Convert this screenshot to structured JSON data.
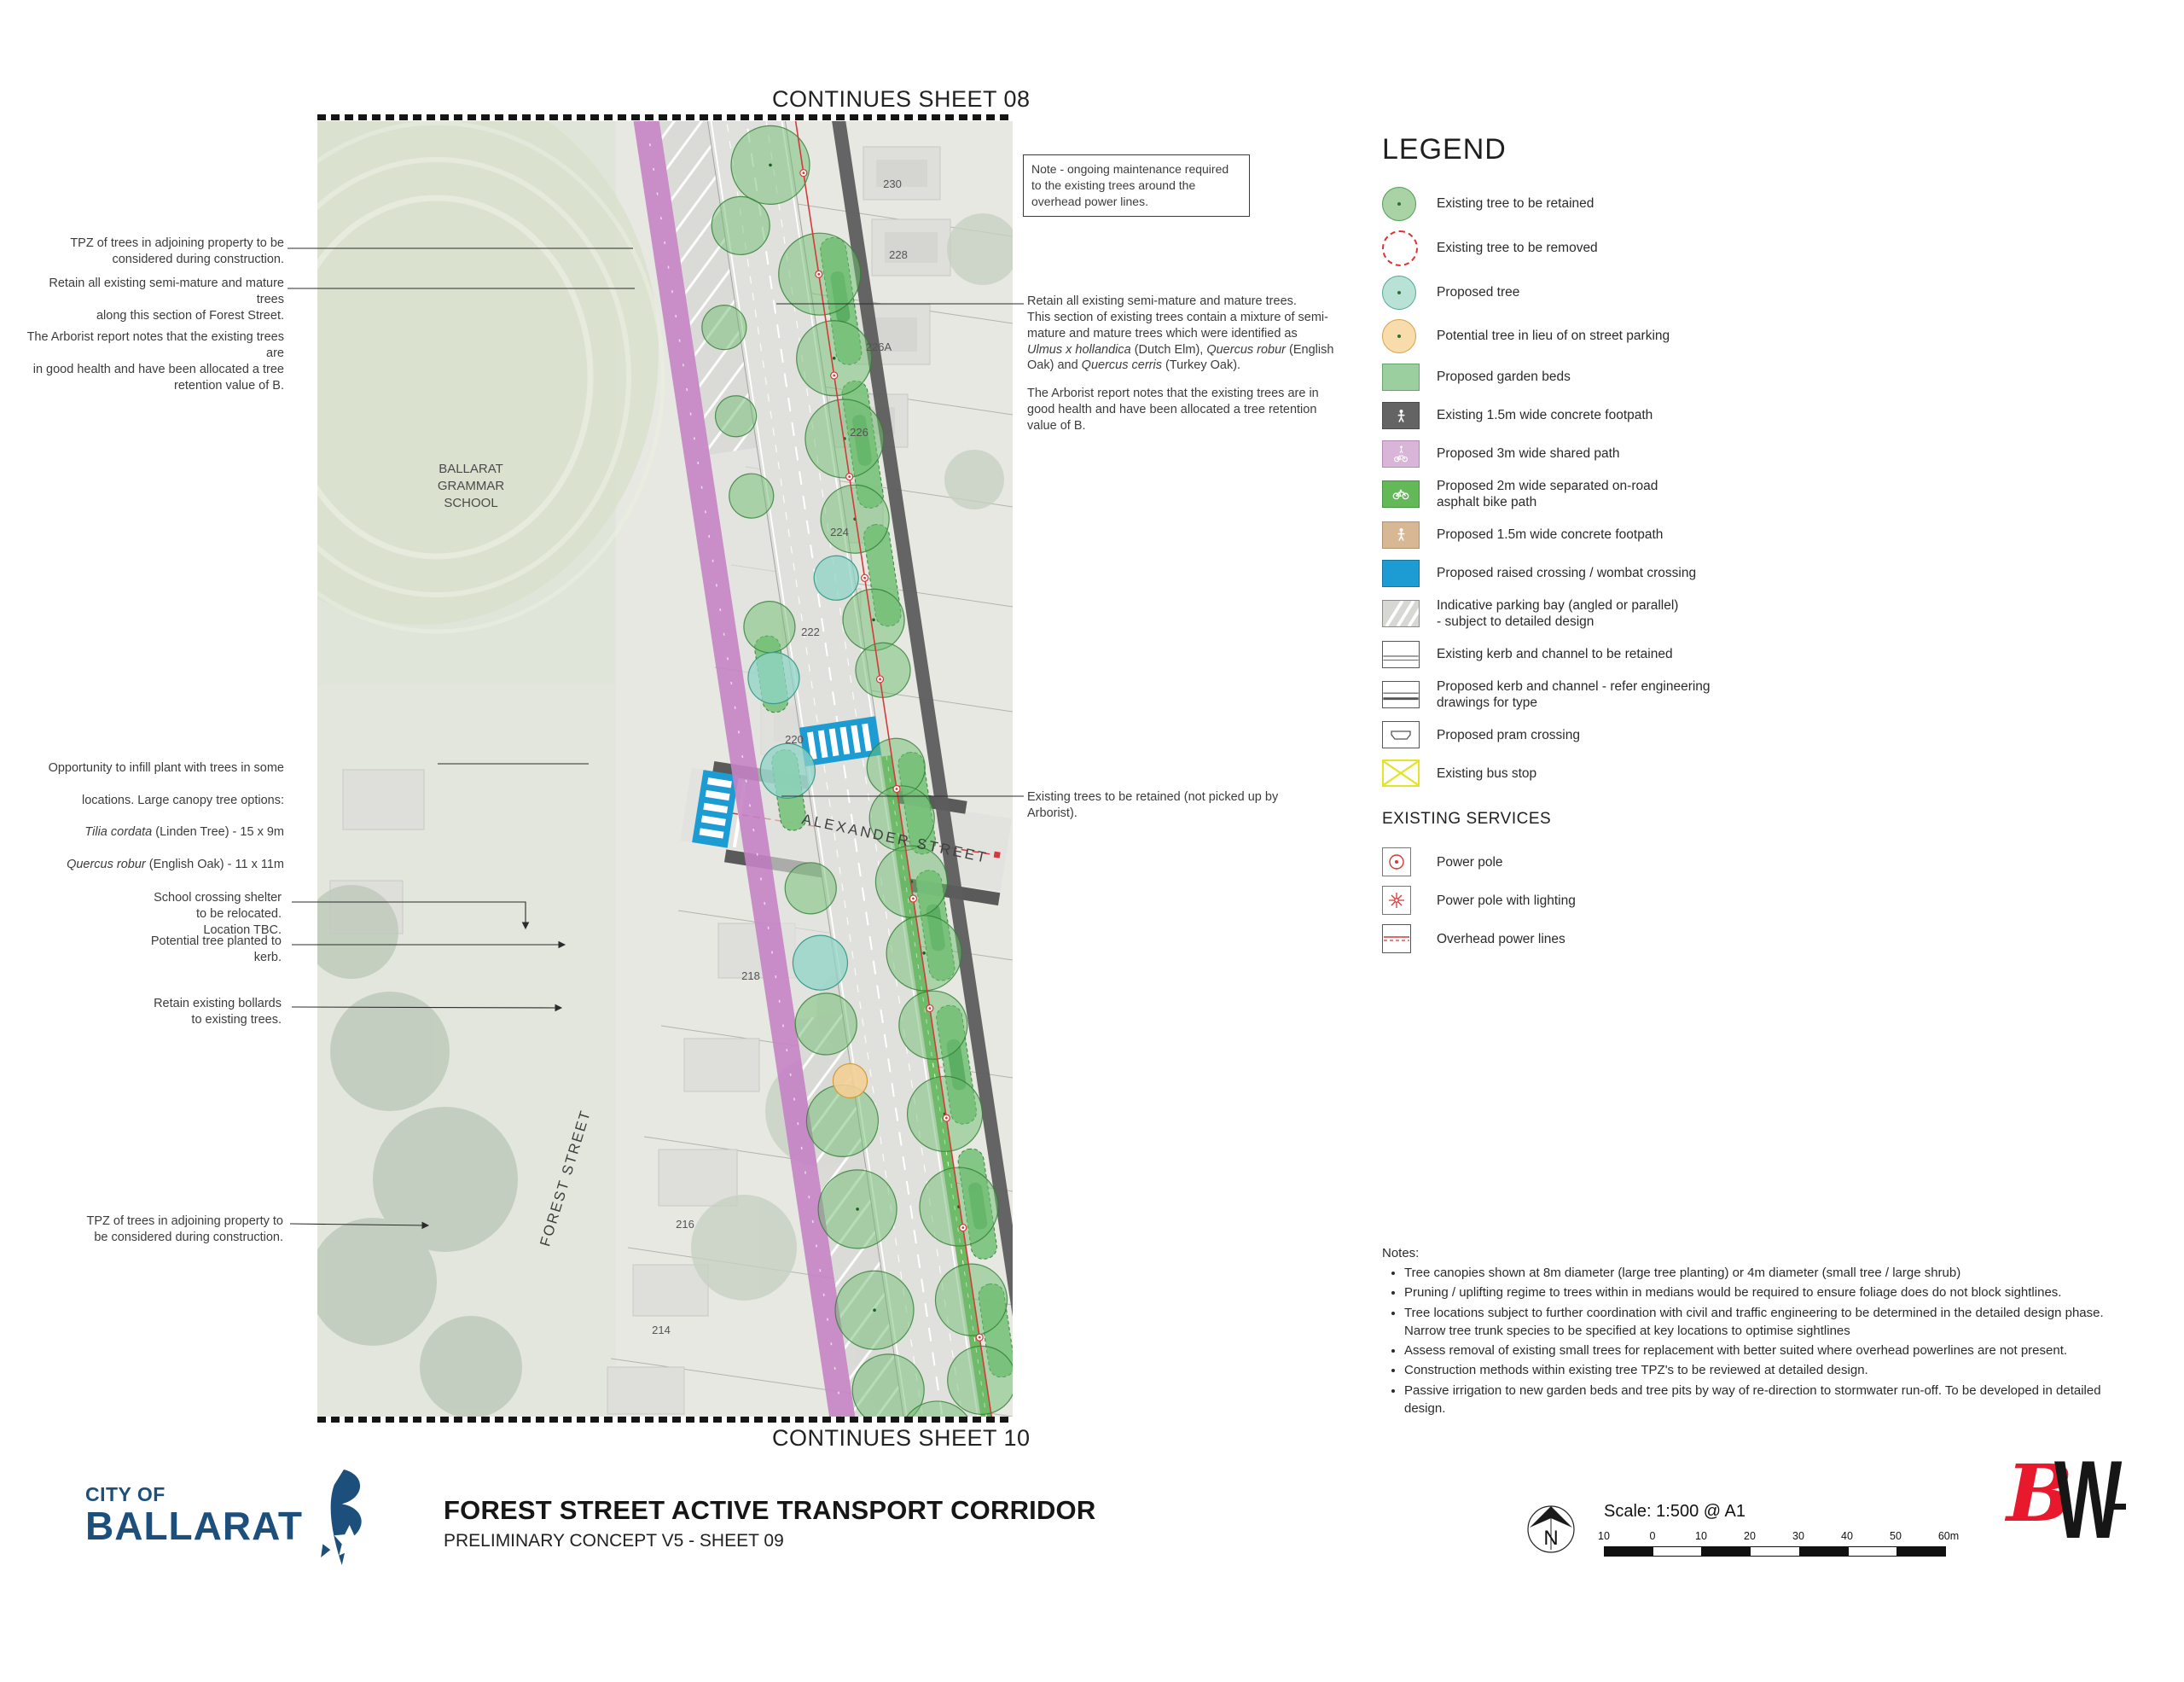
{
  "map": {
    "continues_top": "CONTINUES SHEET 08",
    "continues_bottom": "CONTINUES SHEET 10",
    "labels": {
      "school_1": "BALLARAT",
      "school_2": "GRAMMAR",
      "school_3": "SCHOOL",
      "alexander": "ALEXANDER STREET",
      "forest": "FOREST STREET"
    },
    "house_numbers": [
      "230",
      "228",
      "226A",
      "226",
      "224",
      "222",
      "220",
      "218",
      "216",
      "214"
    ],
    "note_box": "Note - ongoing maintenance required to the existing trees around the overhead power lines."
  },
  "annotations_left": {
    "tpz_top": "TPZ of trees in adjoining property to be\nconsidered during construction.",
    "retain": "Retain all existing semi-mature and mature trees\nalong this section of Forest Street.",
    "arborist": "The Arborist report notes that the existing trees are\nin good health and have been allocated a tree\nretention value of B.",
    "infill": {
      "l1": "Opportunity to infill plant with trees in some",
      "l2": "locations. Large canopy tree options:",
      "sp1": "Tilia cordata",
      "l3": " (Linden Tree) - 15 x 9m",
      "sp2": "Quercus robur",
      "l4": " (English Oak) - 11 x 11m"
    },
    "shelter": "School crossing shelter\nto be relocated.\nLocation TBC.",
    "kerb_tree": "Potential tree planted to\nkerb.",
    "bollards": "Retain existing bollards\nto existing trees.",
    "tpz_bottom": "TPZ of trees in adjoining property to\nbe considered during construction."
  },
  "annotations_right": {
    "retain_title": "Retain all existing semi-mature and mature trees.",
    "retain_body": "This section of existing trees contain a mixture of semi-mature and mature trees which were identified as ",
    "sp1": "Ulmus x hollandica",
    "mid1": " (Dutch Elm), ",
    "sp2": "Quercus robur",
    "mid2": " (English Oak) and ",
    "sp3": "Quercus cerris",
    "end": " (Turkey Oak).",
    "arborist": "The Arborist report notes that the existing trees are in good health and have been allocated a tree retention value of B.",
    "existing_trees": "Existing trees to be retained (not picked up by Arborist)."
  },
  "legend": {
    "title": "LEGEND",
    "items": [
      {
        "icon": "tree-retained",
        "label": "Existing tree to be retained"
      },
      {
        "icon": "tree-removed",
        "label": "Existing tree to be removed"
      },
      {
        "icon": "tree-proposed",
        "label": "Proposed tree"
      },
      {
        "icon": "tree-potential",
        "label": "Potential tree in lieu of on street parking"
      },
      {
        "icon": "garden-beds",
        "label": "Proposed garden beds"
      },
      {
        "icon": "existing-footpath",
        "label": "Existing 1.5m wide concrete footpath"
      },
      {
        "icon": "shared-path",
        "label": "Proposed 3m wide shared path"
      },
      {
        "icon": "bike-path",
        "label": "Proposed 2m wide separated on-road\nasphalt bike path"
      },
      {
        "icon": "proposed-footpath",
        "label": "Proposed 1.5m wide concrete footpath"
      },
      {
        "icon": "raised-crossing",
        "label": "Proposed raised crossing / wombat crossing"
      },
      {
        "icon": "parking-bay",
        "label": "Indicative parking bay (angled or parallel)\n- subject to detailed design"
      },
      {
        "icon": "kerb-existing",
        "label": "Existing kerb and channel to be retained"
      },
      {
        "icon": "kerb-proposed",
        "label": "Proposed kerb and channel - refer engineering\ndrawings for type"
      },
      {
        "icon": "pram-crossing",
        "label": "Proposed pram crossing"
      },
      {
        "icon": "bus-stop",
        "label": "Existing bus stop"
      }
    ],
    "services_title": "EXISTING SERVICES",
    "services": [
      {
        "icon": "power-pole",
        "label": "Power pole"
      },
      {
        "icon": "power-pole-lighting",
        "label": "Power pole with lighting"
      },
      {
        "icon": "overhead-lines",
        "label": "Overhead power lines"
      }
    ]
  },
  "notes": {
    "title": "Notes:",
    "items": [
      "Tree canopies shown at 8m diameter (large tree planting) or 4m diameter (small tree / large shrub)",
      "Pruning / uplifting regime to trees within in medians would be required to ensure foliage does do not block sightlines.",
      "Tree locations subject to further coordination with civil and traffic engineering to be determined in the detailed design phase. Narrow tree trunk species to be specified at key locations to optimise sightlines",
      "Assess removal of existing small trees for replacement with better suited where overhead powerlines are not present.",
      "Construction methods within existing tree TPZ's to be reviewed at detailed design.",
      "Passive irrigation to new garden beds and tree pits by way of re-direction to stormwater run-off. To be developed in detailed design."
    ]
  },
  "footer": {
    "logo_small": "CITY OF",
    "logo_large": "BALLARAT",
    "title": "FOREST STREET ACTIVE TRANSPORT CORRIDOR",
    "subtitle": "PRELIMINARY CONCEPT V5 - SHEET 09",
    "north_label": "N",
    "scale_text": "Scale: 1:500 @ A1",
    "scale_labels": [
      "10",
      "0",
      "10",
      "20",
      "30",
      "40",
      "50",
      "60m"
    ],
    "bw_b": "B",
    "bw_w": "W"
  },
  "colors": {
    "navy": "#1d4f7c",
    "bw_red": "#e8192c",
    "crossing_blue": "#1d9cd3",
    "tree_green": "#6fbe72",
    "proposed_teal": "#8fd4c6",
    "potential_orange": "#f3cf95",
    "garden_green": "#7cc47f",
    "shared_path_purple": "#c583c5",
    "bike_green": "#63b858",
    "footpath_grey": "#646464",
    "proposed_footpath_tan": "#d8b795",
    "power_red": "#d43a3a",
    "bus_stop_yellow": "#e3e32a"
  }
}
